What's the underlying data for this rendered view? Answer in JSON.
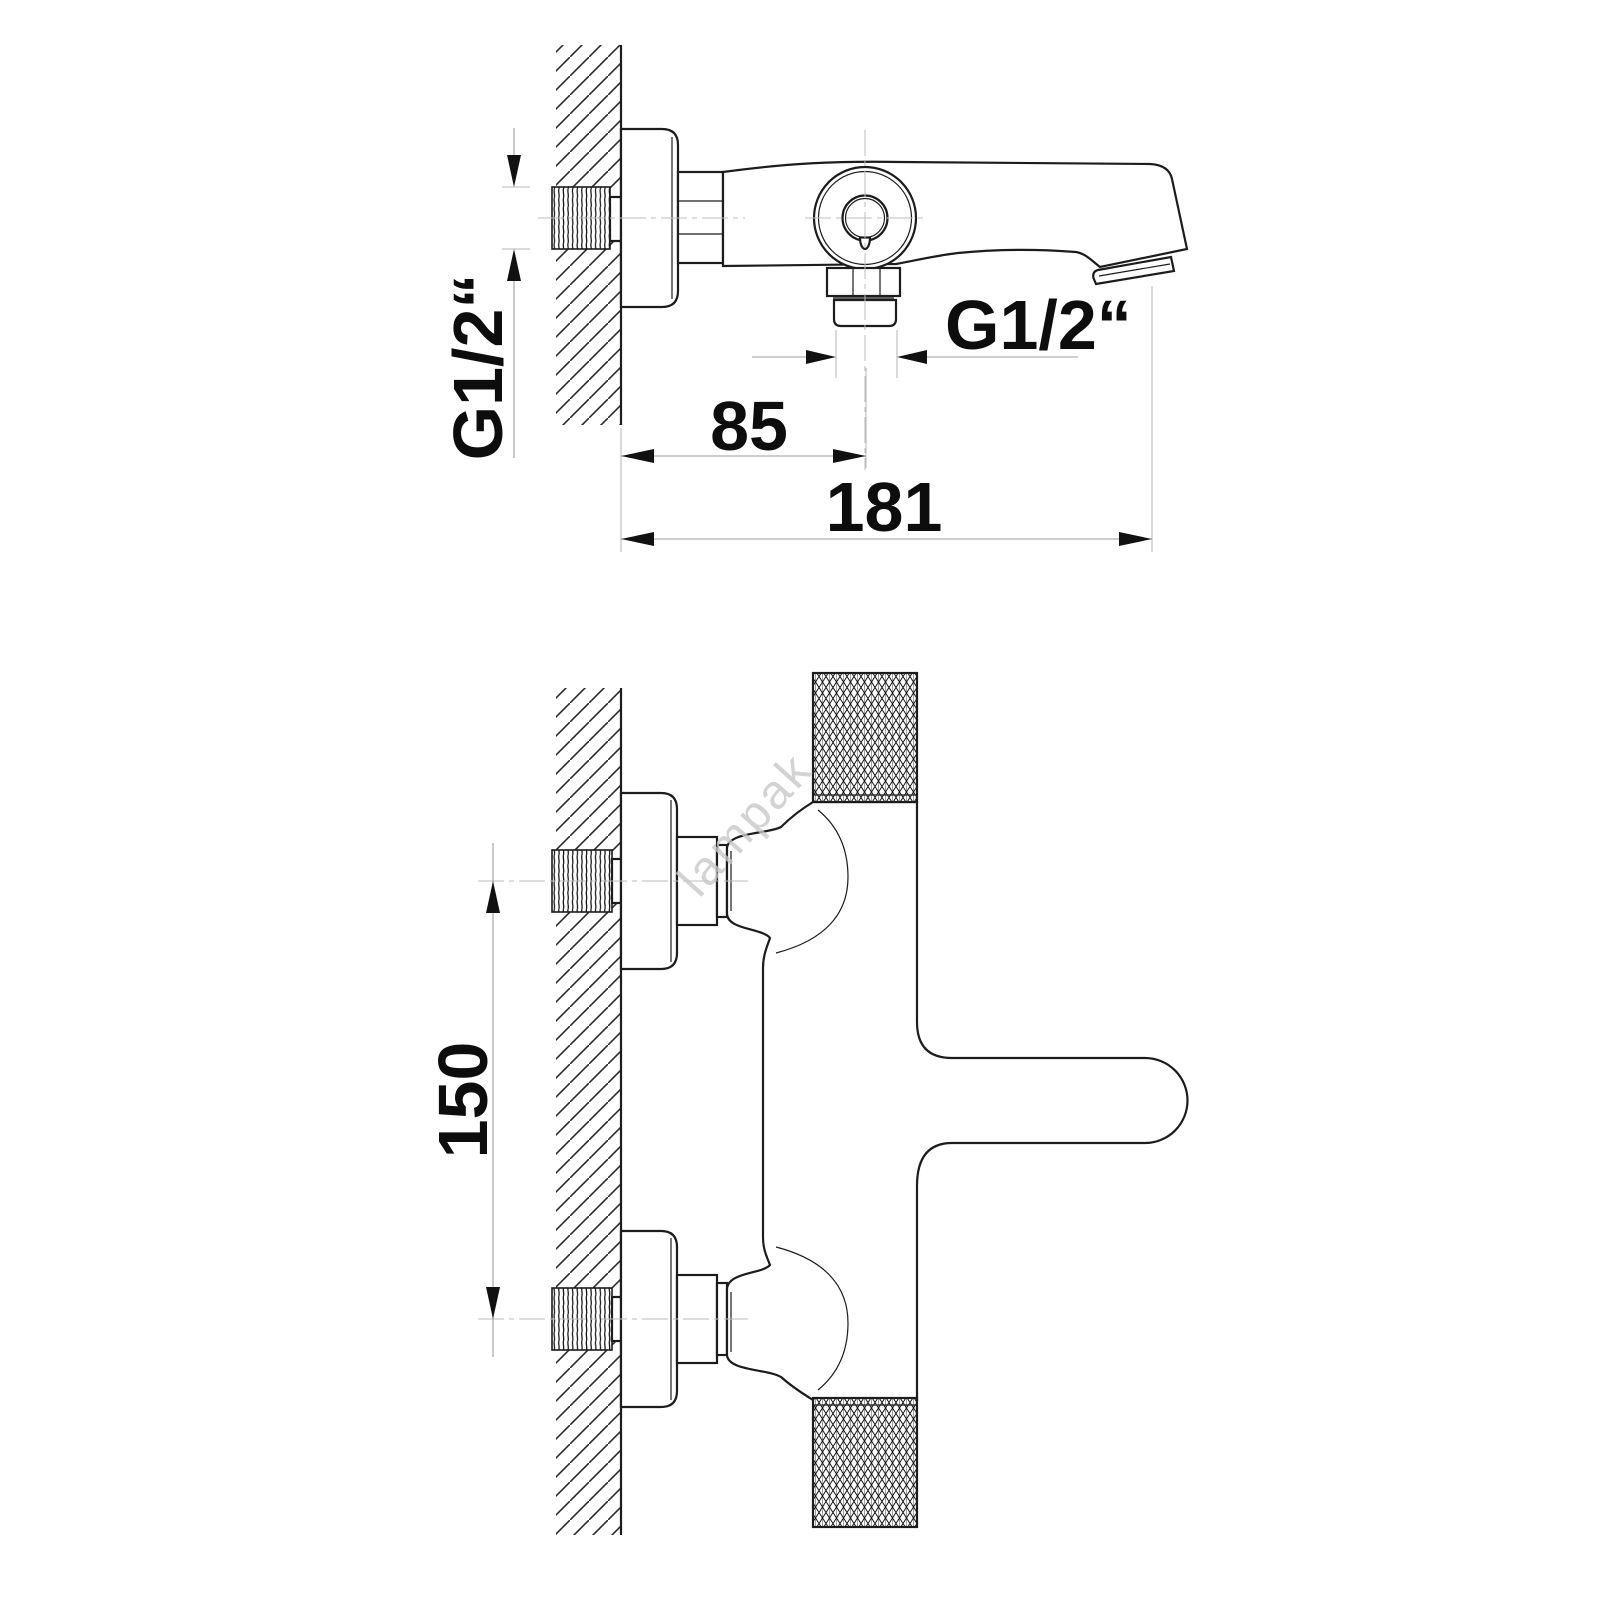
{
  "drawing": {
    "product": "wall-mounted bath mixer tap - dimensional technical drawing, two orthographic views",
    "watermark": "lampak",
    "colors": {
      "background": "#ffffff",
      "outline": "#1c1c1c",
      "dimension_line": "#9e9e9e",
      "centerline": "#bdbdbd",
      "label": "#0d0d0d",
      "watermark": "#c9c9c9"
    },
    "top_view": {
      "name": "top view (plan)",
      "wall_thread_label": "G1/2“",
      "outlet_thread_label": "G1/2“",
      "wall_to_outlet": "85",
      "overall_length": "181"
    },
    "front_view": {
      "name": "front view (elevation)",
      "inlet_spacing": "150"
    }
  }
}
